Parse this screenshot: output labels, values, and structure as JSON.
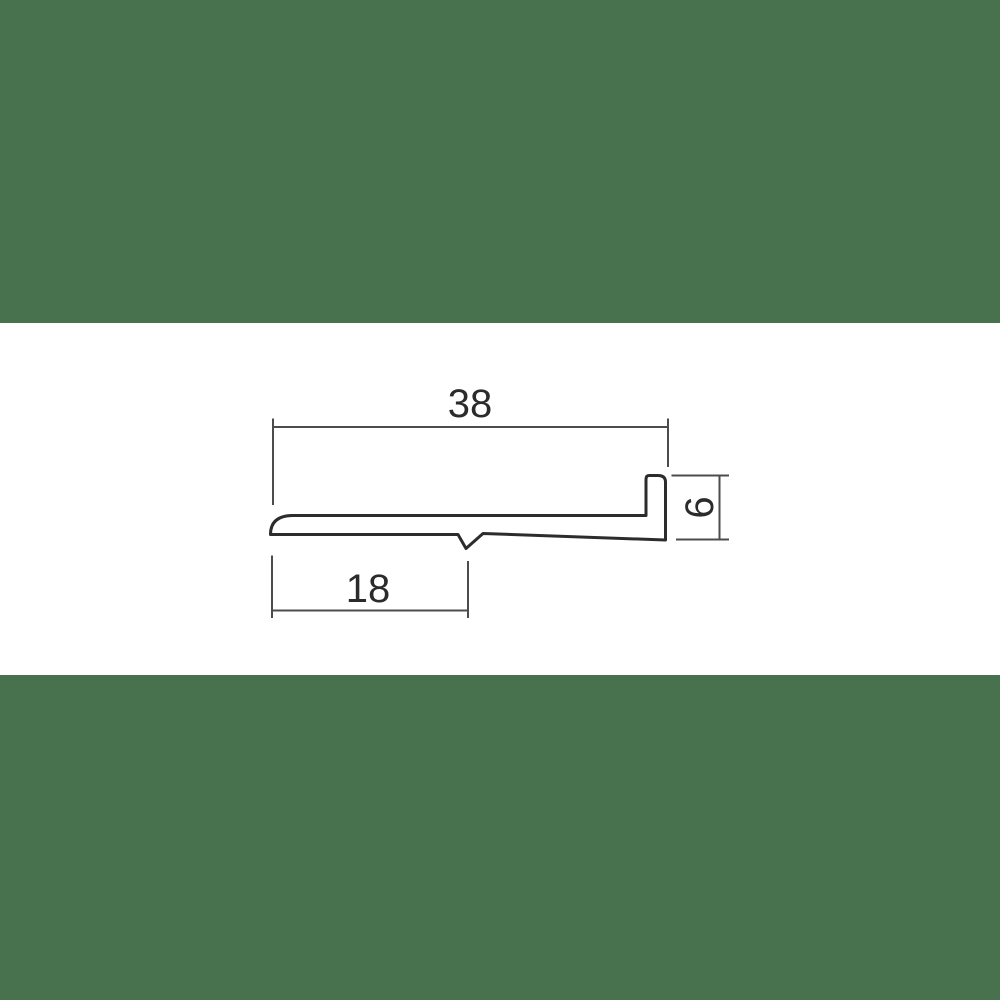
{
  "page": {
    "background": "#ffffff",
    "description": "technical cross-section drawing of a trim profile between two green bands"
  },
  "colors": {
    "band_green": "#48714e",
    "profile_line": "#2c2c2c",
    "dimension_line": "#4c4c4c",
    "text": "#2b2b2b"
  },
  "drawing": {
    "type": "profile-cross-section",
    "dimensions": {
      "total_width": {
        "label": "38",
        "value": 38,
        "orientation": "horizontal",
        "position": "top"
      },
      "partial_width": {
        "label": "18",
        "value": 18,
        "orientation": "horizontal",
        "position": "bottom-left"
      },
      "flange_height": {
        "label": "6",
        "value": 6,
        "orientation": "vertical-rotated",
        "position": "right"
      }
    }
  }
}
